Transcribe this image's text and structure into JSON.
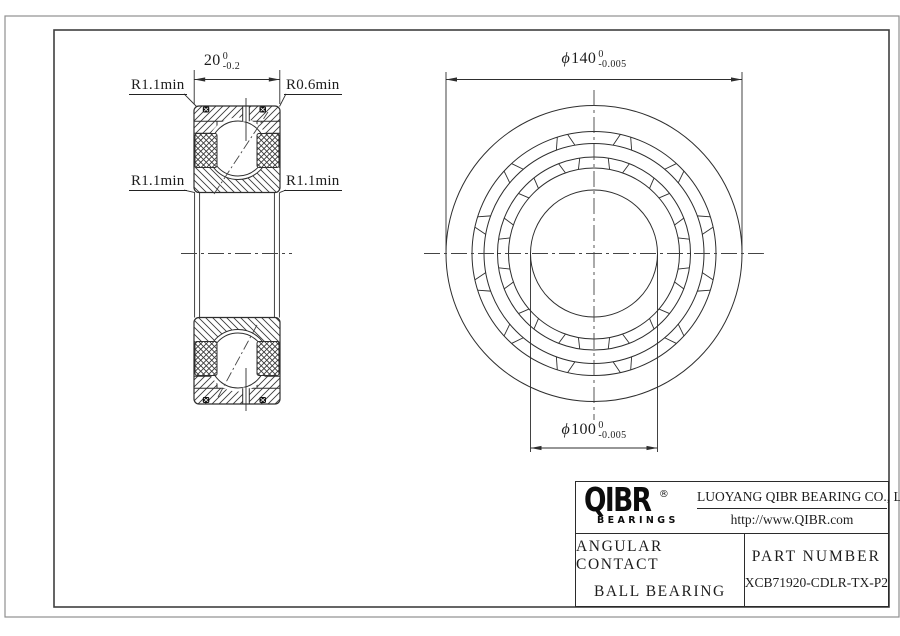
{
  "section_view": {
    "dim_width": {
      "value": "20",
      "tol_upper": "0",
      "tol_lower": "-0.2"
    },
    "label_top_left": "R1.1min",
    "label_top_right": "R0.6min",
    "label_mid_left": "R1.1min",
    "label_mid_right": "R1.1min"
  },
  "front_view": {
    "dim_outer": {
      "symbol": "ϕ",
      "value": "140",
      "tol_upper": "0",
      "tol_lower": "-0.005"
    },
    "dim_bore": {
      "symbol": "ϕ",
      "value": "100",
      "tol_upper": "0",
      "tol_lower": "-0.005"
    }
  },
  "title_block": {
    "brand": "QIBR",
    "brand_registered": "®",
    "brand_sub": "BEARINGS",
    "company": "LUOYANG QIBR BEARING CO., LTD",
    "website": "http://www.QIBR.com",
    "product_type_line1": "ANGULAR CONTACT",
    "product_type_line2": "BALL BEARING",
    "part_number_label": "PART NUMBER",
    "part_number": "XCB71920-CDLR-TX-P2"
  },
  "colors": {
    "line": "#2e2e2e",
    "frame_outer": "#8f8f8f",
    "frame_inner": "#3f3f3f",
    "background": "#ffffff"
  }
}
